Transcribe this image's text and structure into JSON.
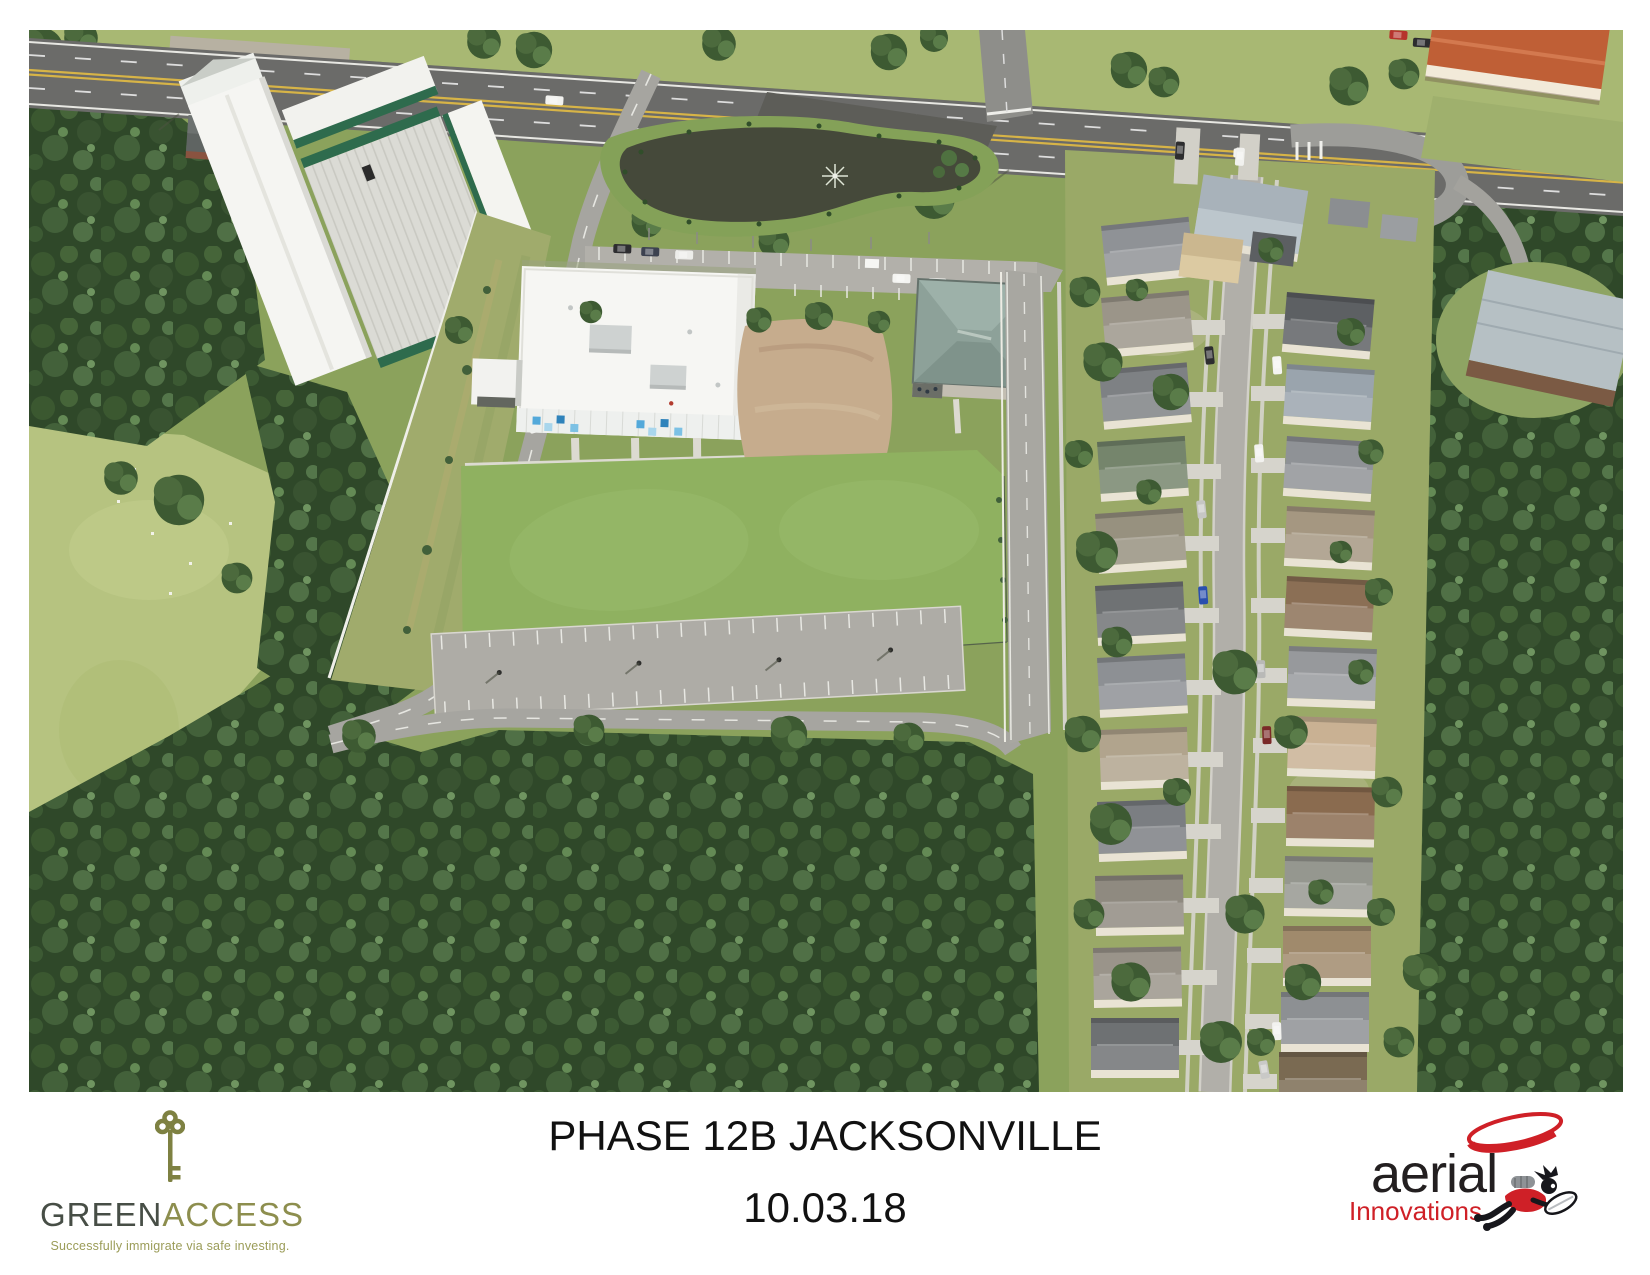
{
  "page": {
    "background_color": "#ffffff"
  },
  "caption": {
    "title": "PHASE 12B JACKSONVILLE",
    "date": "10.03.18"
  },
  "greenaccess": {
    "wordmark_part1": "GREEN",
    "wordmark_part2": "ACCESS",
    "tagline": "Successfully immigrate via safe investing.",
    "color_olive": "#8d8e4e",
    "color_dark": "#474e46",
    "key_icon_color": "#7e8142"
  },
  "aerial_innovations": {
    "wordmark": "aerial",
    "wordmark_sub": "Innovations",
    "color_red": "#cf2027",
    "color_black": "#231f20"
  },
  "photo": {
    "subject": "Aerial photograph: retention pond with fountain, new white building, self-storage facility, open lawn, parking lots, residential street with houses, surrounded by woods"
  }
}
